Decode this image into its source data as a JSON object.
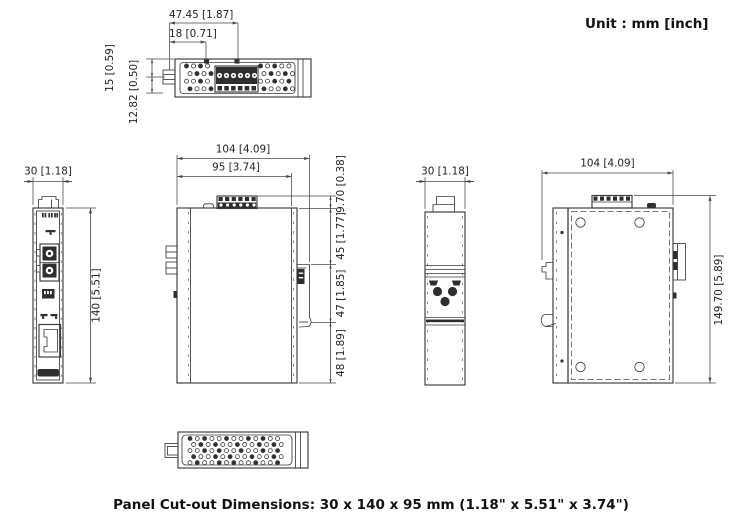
{
  "unit_note": "Unit : mm [inch]",
  "footer": "Panel Cut-out Dimensions: 30 x 140 x 95 mm (1.18\" x 5.51\" x 3.74\")",
  "colors": {
    "line": "#3b3b3e",
    "text": "#232327",
    "fill_dark": "#2e2e31",
    "background": "#ffffff"
  },
  "views": {
    "top": {
      "dim_width_overall": "47.45 [1.87]",
      "dim_width_terminal": "18 [0.71]",
      "dim_depth_upper": "15 [0.59]",
      "dim_depth_lower": "12.82 [0.50]"
    },
    "front": {
      "dim_width": "30 [1.18]",
      "dim_height": "140 [5.51]"
    },
    "left_side": {
      "dim_depth_overall": "104 [4.09]",
      "dim_depth_body": "95 [3.74]",
      "dim_terminal_height": "9.70 [0.38]",
      "dim_upper": "45 [1.77]",
      "dim_din_clip": "47 [1.85]",
      "dim_lower": "48 [1.89]"
    },
    "rear": {
      "dim_width": "30 [1.18]"
    },
    "right_side": {
      "dim_depth_overall": "104 [4.09]",
      "dim_height_overall": "149.70 [5.89]"
    }
  }
}
